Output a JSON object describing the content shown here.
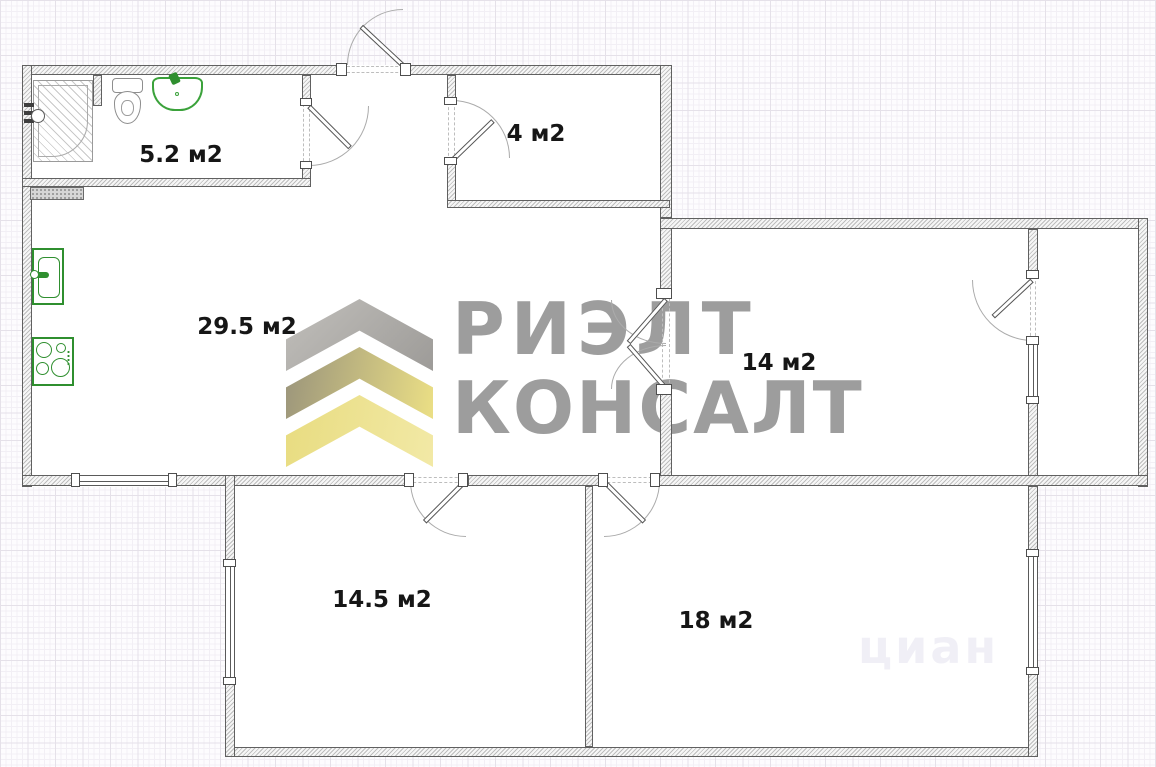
{
  "plan": {
    "rooms": [
      {
        "name": "bathroom",
        "area_label": "5.2 м2"
      },
      {
        "name": "entry-room",
        "area_label": "4 м2"
      },
      {
        "name": "kitchen-living-room",
        "area_label": "29.5 м2"
      },
      {
        "name": "room-right",
        "area_label": "14 м2"
      },
      {
        "name": "room-bottom-left",
        "area_label": "14.5 м2"
      },
      {
        "name": "room-bottom-right",
        "area_label": "18 м2"
      }
    ],
    "fixtures": [
      "shower",
      "toilet",
      "wash-basin",
      "kitchen-sink",
      "stove",
      "vent-shaft"
    ]
  },
  "branding": {
    "logo_line1": "РИЭЛТ",
    "logo_line2": "КОНСАЛТ",
    "logo_text_color": "#9d9d9d",
    "chevron_gray": "#b2b0ad",
    "chevron_gold": "#e9de86",
    "chevron_yellow": "#ece189"
  },
  "faint_watermark": "циан"
}
